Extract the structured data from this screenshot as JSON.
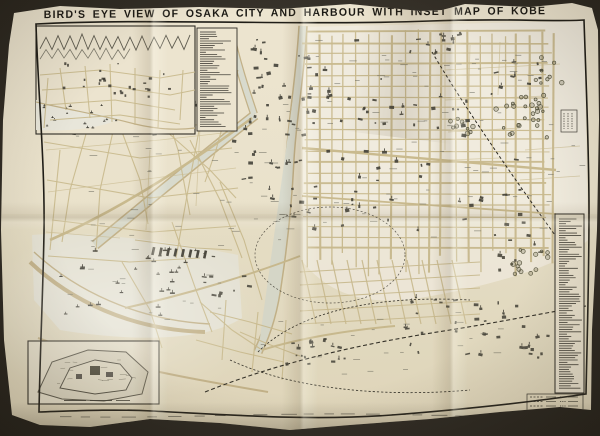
{
  "map": {
    "title": "BIRD'S EYE VIEW OF OSAKA CITY AND HARBOUR WITH INSET MAP OF KOBE",
    "colors": {
      "background": "#2b2720",
      "paper": "#e8e0c9",
      "ink": "#1f1d17",
      "street": "#c9ba8e",
      "block": "#f1ece0",
      "water": "#d8dacd",
      "harbor": "#e8e6da",
      "shore": "#c2b188",
      "building": "#3e3c34",
      "tree": "#55543f",
      "label": "#6b6b60",
      "legend_text": "#26241f"
    }
  }
}
